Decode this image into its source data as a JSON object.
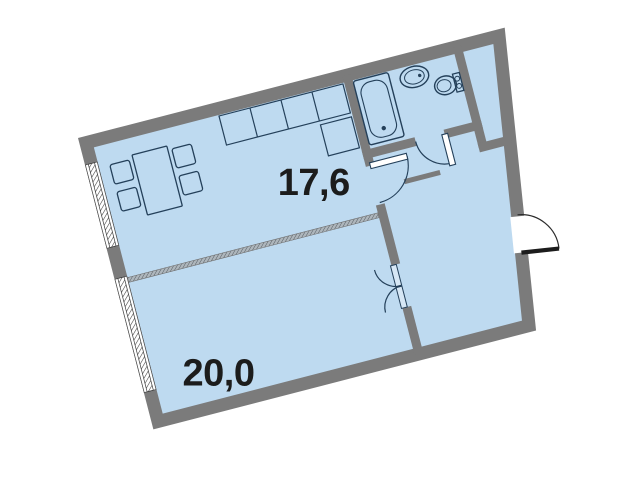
{
  "plan": {
    "type": "apartment-floor-plan",
    "background": "#ffffff",
    "colors": {
      "floor": "#bedaf0",
      "wall": "#7b7b7b",
      "fixture_outline": "#24405a",
      "label": "#1c1c1c",
      "window_fill": "#ffffff"
    },
    "rotation_deg": -14.5,
    "rooms": [
      {
        "name": "living-room-kitchen",
        "area_label": "17,6"
      },
      {
        "name": "bedroom",
        "area_label": "20,0"
      },
      {
        "name": "bathroom",
        "area_label": ""
      },
      {
        "name": "hallway",
        "area_label": ""
      },
      {
        "name": "closet-shaft",
        "area_label": ""
      }
    ],
    "fixtures": [
      "bathtub",
      "sink",
      "toilet",
      "kitchen-counter",
      "dining-table",
      "chair",
      "chair",
      "chair",
      "chair"
    ],
    "openings": {
      "windows": 2,
      "interior_doors": 3,
      "double_door": 1,
      "entrance_door": 1
    }
  }
}
